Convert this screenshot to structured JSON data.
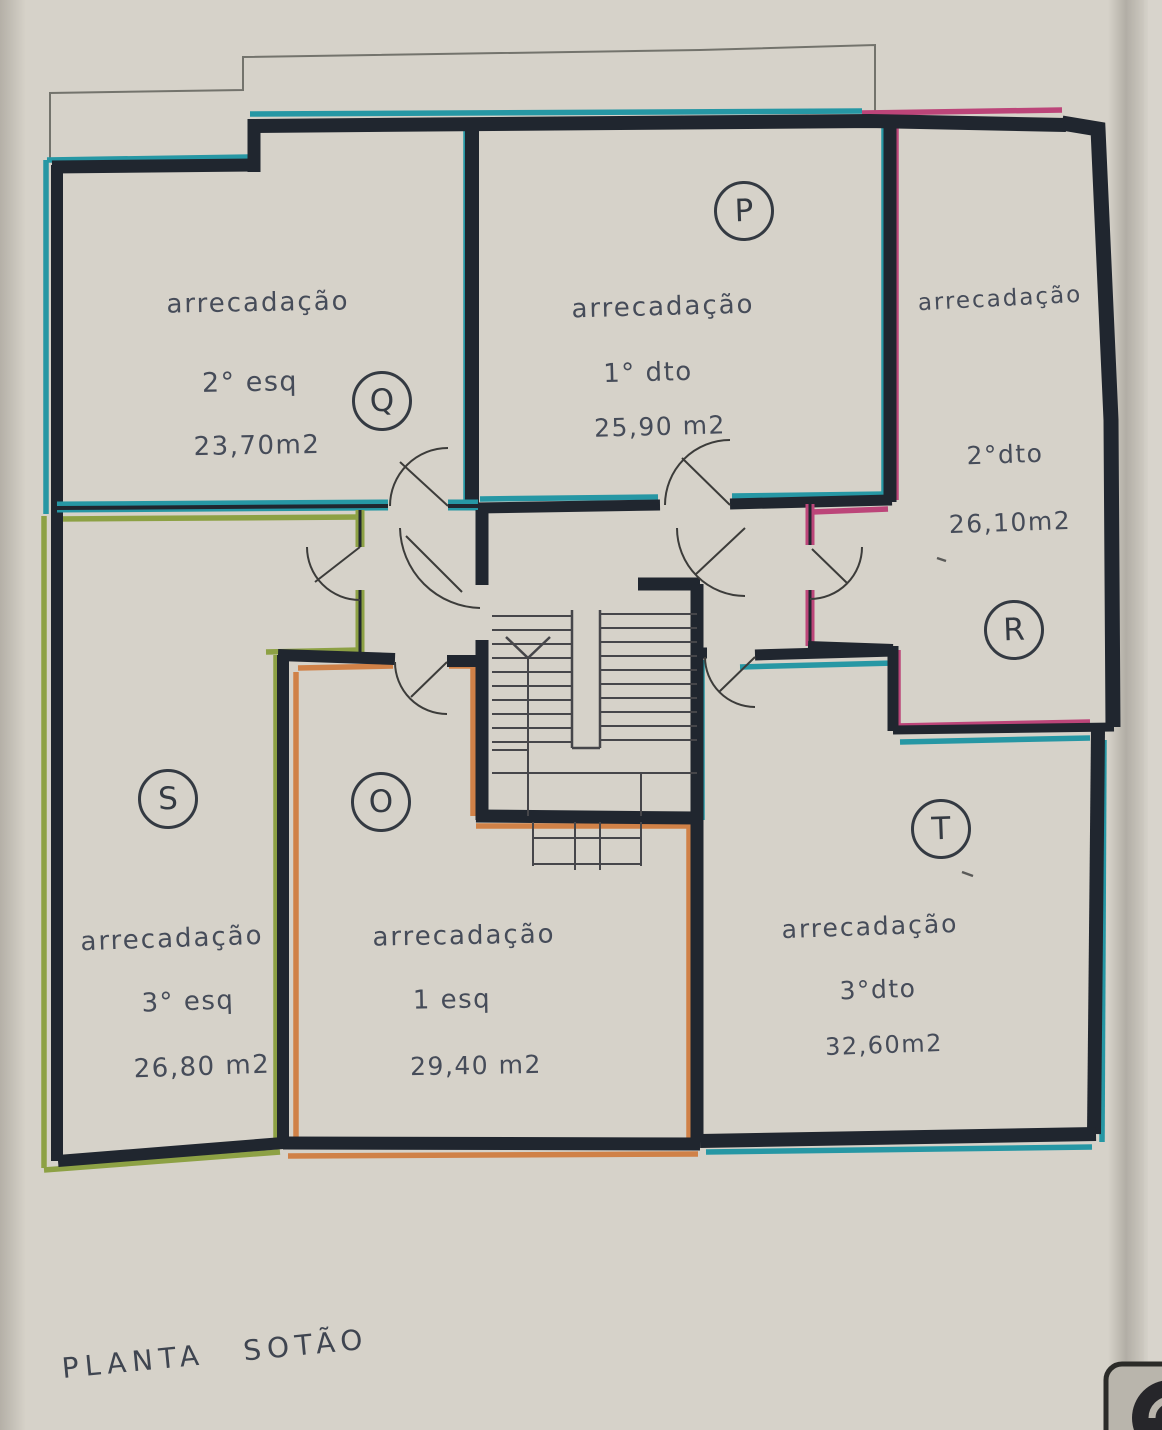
{
  "document": {
    "title": "PLANTA SOTÃO",
    "type_note": "scanned attic storage floor plan"
  },
  "rooms": [
    {
      "id": "Q",
      "badge": "Q",
      "label": "arrecadação",
      "floor": "2° esq",
      "area": "23,70m2",
      "outline_color": "#2697a4"
    },
    {
      "id": "P",
      "badge": "P",
      "label": "arrecadação",
      "floor": "1° dto",
      "area": "25,90 m2",
      "outline_color": "#2697a4"
    },
    {
      "id": "R",
      "badge": "R",
      "label": "arrecadação",
      "floor": "2°dto",
      "area": "26,10m2",
      "outline_color": "#bc4579"
    },
    {
      "id": "S",
      "badge": "S",
      "label": "arrecadação",
      "floor": "3° esq",
      "area": "26,80 m2",
      "outline_color": "#8da144"
    },
    {
      "id": "O",
      "badge": "O",
      "label": "arrecadação",
      "floor": "1 esq",
      "area": "29,40 m2",
      "outline_color": "#d08147"
    },
    {
      "id": "T",
      "badge": "T",
      "label": "arrecadação",
      "floor": "3°dto",
      "area": "32,60m2",
      "outline_color": "#2697a4"
    }
  ],
  "colors": {
    "wall": "#20262f",
    "teal": "#2697a4",
    "green": "#8da144",
    "orange": "#d08147",
    "pink": "#bc4579",
    "paper": "#d6d2c9"
  }
}
